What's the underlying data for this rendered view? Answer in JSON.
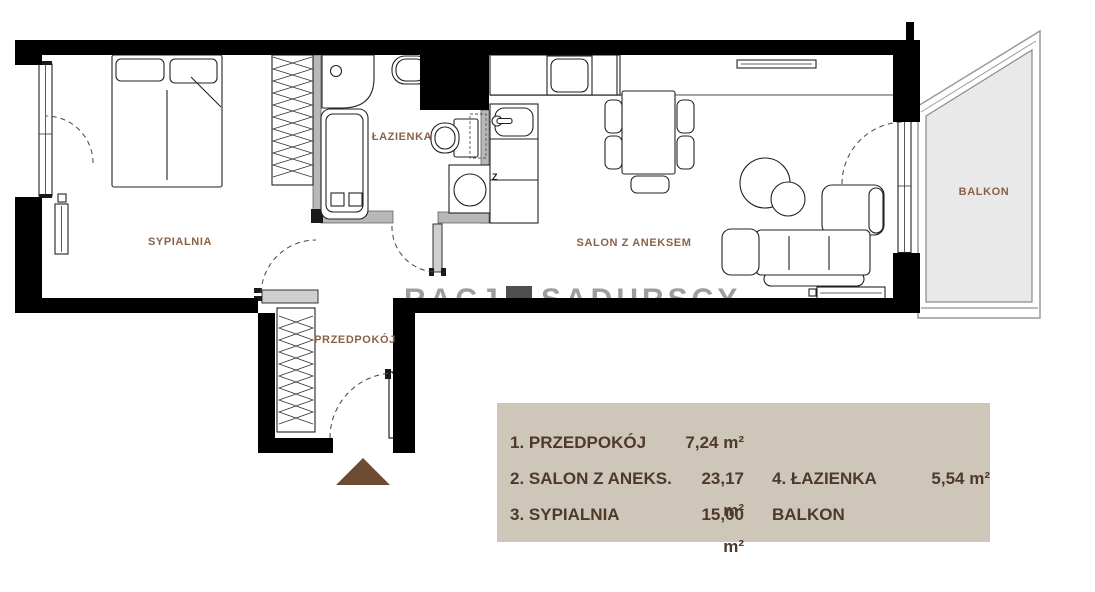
{
  "plan": {
    "rooms": {
      "bedroom": "SYPIALNIA",
      "bathroom": "ŁAZIENKA",
      "living_room": "SALON Z ANEKSEM",
      "hallway": "PRZEDPOKÓJ",
      "balcony": "BALKON"
    },
    "kitchen_marker": "Z",
    "watermark": {
      "left": "RACJA",
      "right": "SADURSCY"
    }
  },
  "legend": {
    "rows": [
      {
        "left_label": "1. PRZEDPOKÓJ",
        "left_value": "7,24 m²",
        "right_label": "",
        "right_value": ""
      },
      {
        "left_label": "2. SALON Z ANEKS.",
        "left_value": "23,17 m²",
        "right_label": "4. ŁAZIENKA",
        "right_value": "5,54 m²"
      },
      {
        "left_label": "3. SYPIALNIA",
        "left_value": "15,00 m²",
        "right_label": "BALKON",
        "right_value": ""
      }
    ]
  },
  "colors": {
    "wall": "#000000",
    "partition": "#b8b8b8",
    "room_label": "#8a6247",
    "legend_background": "#cfc6ba",
    "legend_text": "#4e3a29",
    "balcony_floor": "#e9e9e9",
    "entrance_arrow": "#6e4b33",
    "watermark": "#9d9d9d"
  }
}
